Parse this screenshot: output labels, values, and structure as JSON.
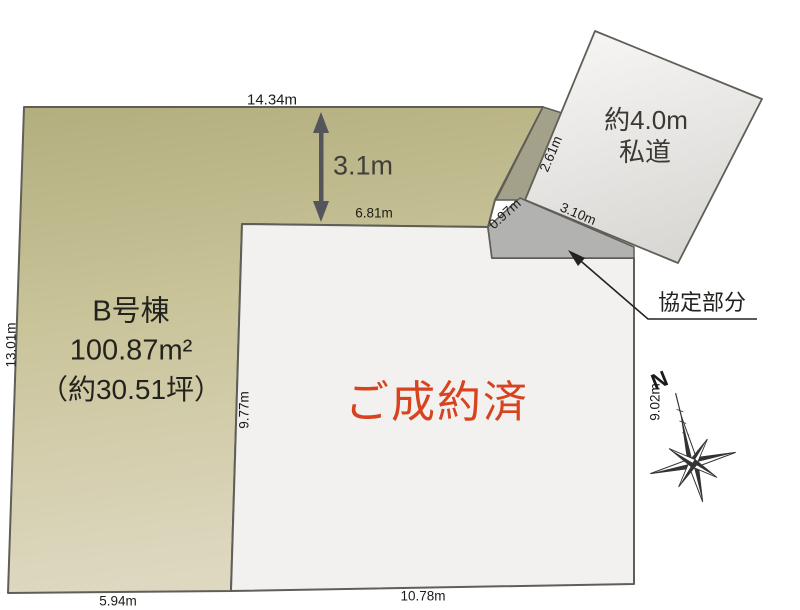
{
  "parcel": {
    "name": "B号棟",
    "area": "100.87m²",
    "area_tsubo": "（約30.51坪）"
  },
  "status": {
    "label": "ご成約済",
    "color": "#d8431f"
  },
  "road": {
    "line1": "約4.0m",
    "line2": "私道"
  },
  "agreement": {
    "label": "協定部分"
  },
  "compass": {
    "north": "N"
  },
  "dimensions": {
    "top_edge": "14.34m",
    "setback": "3.1m",
    "sold_top": "6.81m",
    "left_edge": "13.01m",
    "sold_left": "9.77m",
    "sold_right": "9.02m",
    "bottom_left": "5.94m",
    "bottom_right": "10.78m",
    "road_side": "2.61m",
    "agreement_side": "0.97m",
    "agreement_top": "3.10m"
  },
  "colors": {
    "parcel_fill_top": "#b3ae7e",
    "parcel_fill_bottom": "#ded8c1",
    "sold_fill": "#f2f1ef",
    "road_fill_top": "#f7f6f4",
    "road_fill_bottom": "#d9d7d4",
    "agreement_fill": "#b2b2b0",
    "buffer_fill": "#a4a18a",
    "outline": "#5f5e57"
  }
}
